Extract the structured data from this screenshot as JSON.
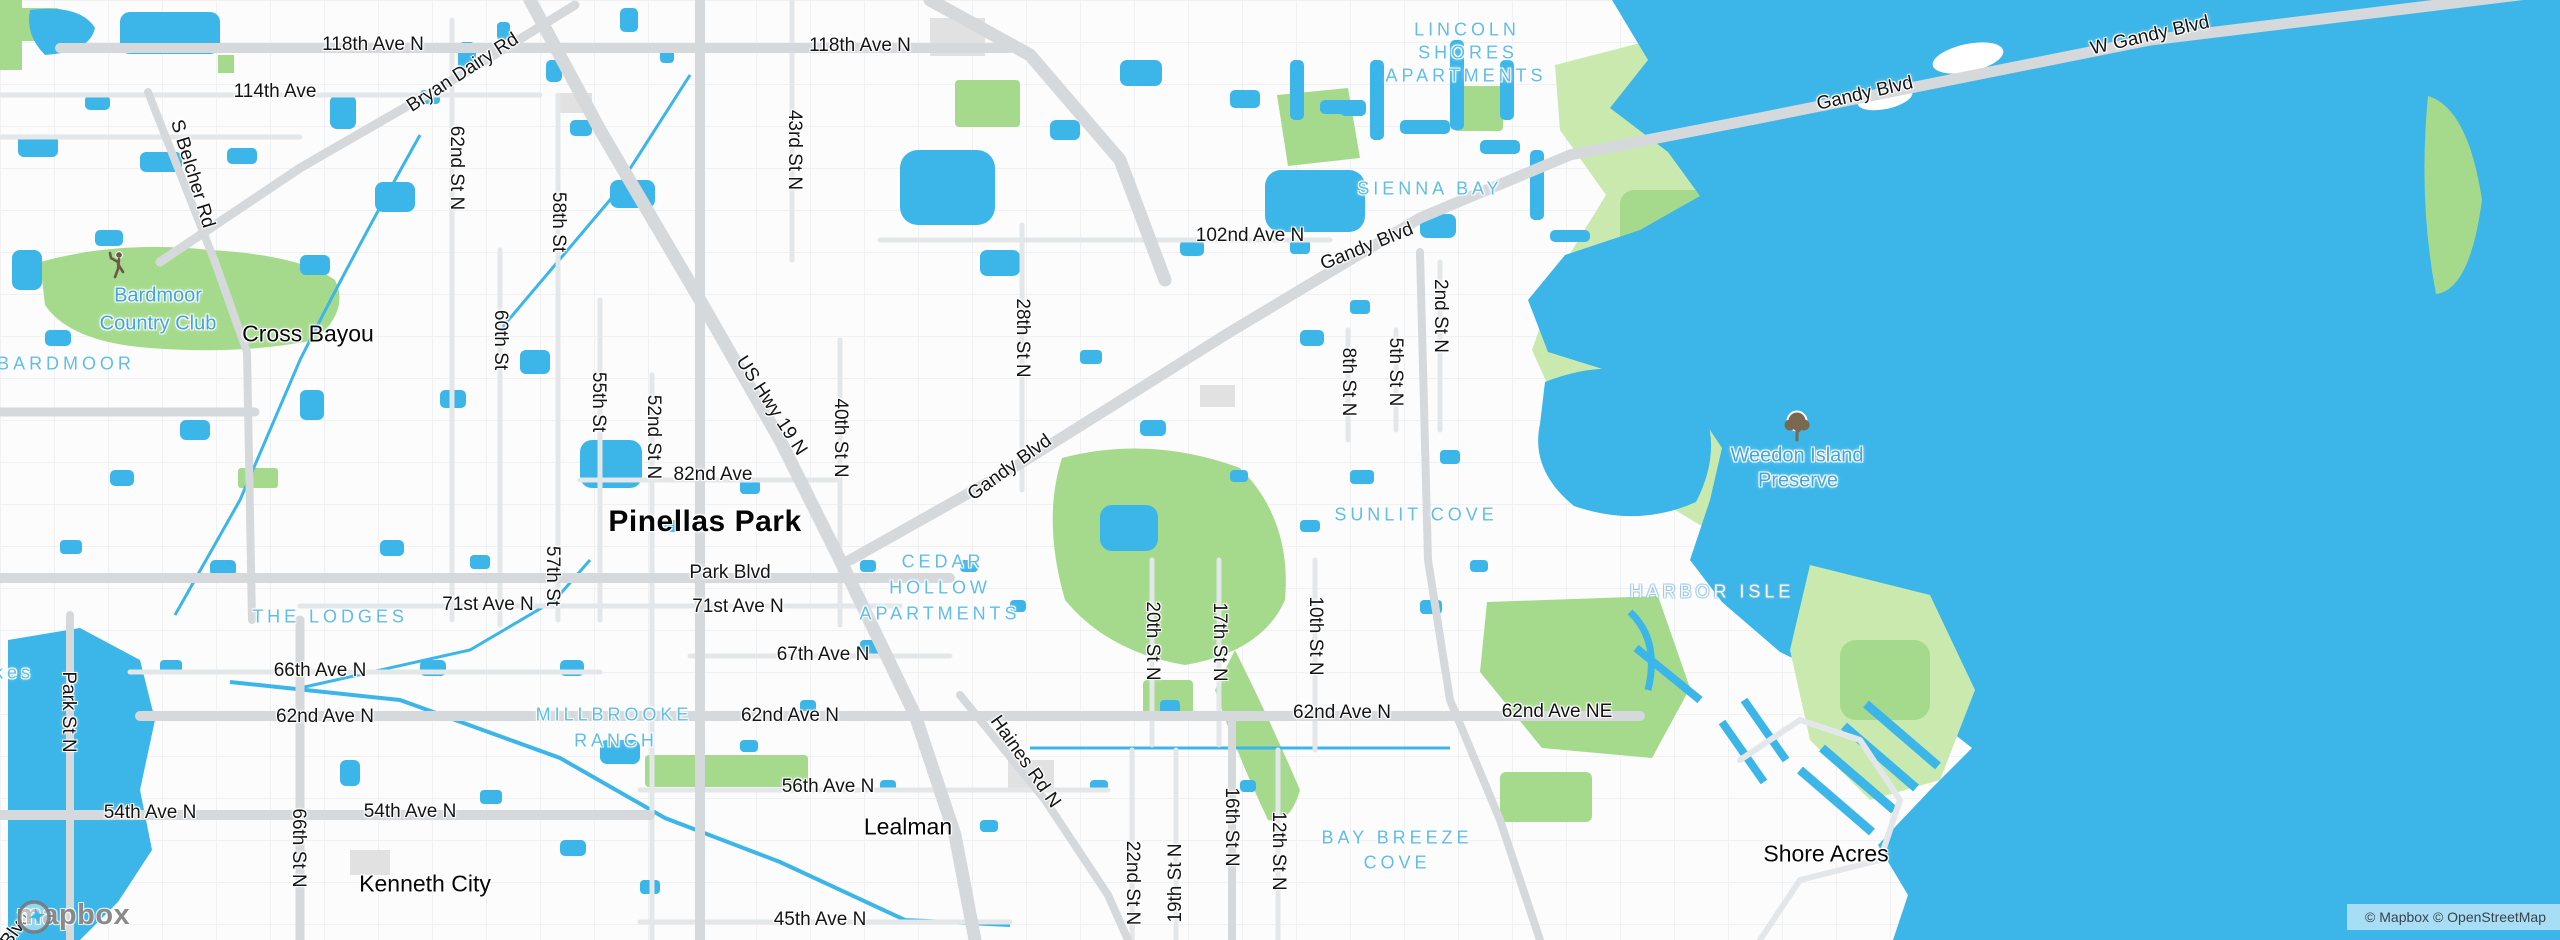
{
  "map": {
    "attribution": "© Mapbox © OpenStreetMap",
    "logo_text": "mapbox",
    "colors": {
      "water": "#3CB6E8",
      "park": "#A5DA8C",
      "preserve": "#C9E9AE",
      "land": "#FCFCFC",
      "road_major": "#D6D9DC",
      "road_minor": "#E4E7E9",
      "grid": "#EEF0F2",
      "building": "#E1E1E1",
      "label_road": "#141414",
      "label_city": "#060606",
      "label_poi": "#3FA5DE",
      "label_area": "#5FBDEB",
      "attribution_text": "#3A424B"
    },
    "icons": [
      {
        "name": "golfer-icon",
        "x": 120,
        "y": 265
      },
      {
        "name": "tree-icon",
        "x": 1797,
        "y": 427
      }
    ],
    "labels": [
      {
        "text": "118th Ave N",
        "x": 373,
        "y": 45,
        "t": "road"
      },
      {
        "text": "114th Ave",
        "x": 275,
        "y": 92,
        "t": "road"
      },
      {
        "text": "Bryan Dairy Rd",
        "x": 463,
        "y": 73,
        "t": "road",
        "rot": -33
      },
      {
        "text": "S Belcher Rd",
        "x": 192,
        "y": 174,
        "t": "road",
        "rot": 73
      },
      {
        "text": "118th Ave N",
        "x": 860,
        "y": 46,
        "t": "road"
      },
      {
        "text": "43rd St N",
        "x": 794,
        "y": 150,
        "t": "road",
        "rot": 90
      },
      {
        "text": "62nd St N",
        "x": 456,
        "y": 168,
        "t": "road",
        "rot": 90
      },
      {
        "text": "58th St",
        "x": 558,
        "y": 222,
        "t": "road",
        "rot": 90
      },
      {
        "text": "60th St",
        "x": 500,
        "y": 340,
        "t": "road",
        "rot": 90
      },
      {
        "text": "55th St",
        "x": 598,
        "y": 402,
        "t": "road",
        "rot": 90
      },
      {
        "text": "52nd St N",
        "x": 653,
        "y": 437,
        "t": "road",
        "rot": 90
      },
      {
        "text": "57th St",
        "x": 552,
        "y": 576,
        "t": "road",
        "rot": 90
      },
      {
        "text": "US Hwy 19 N",
        "x": 771,
        "y": 406,
        "t": "road",
        "rot": 57
      },
      {
        "text": "40th St N",
        "x": 840,
        "y": 438,
        "t": "road",
        "rot": 90
      },
      {
        "text": "28th St N",
        "x": 1022,
        "y": 338,
        "t": "road",
        "rot": 90
      },
      {
        "text": "102nd Ave N",
        "x": 1250,
        "y": 236,
        "t": "road"
      },
      {
        "text": "Gandy Blvd",
        "x": 1367,
        "y": 247,
        "t": "road",
        "rot": -22
      },
      {
        "text": "Gandy Blvd",
        "x": 1010,
        "y": 468,
        "t": "road",
        "rot": -36
      },
      {
        "text": "Gandy Blvd",
        "x": 1865,
        "y": 94,
        "t": "road",
        "rot": -13
      },
      {
        "text": "W Gandy Blvd",
        "x": 2150,
        "y": 36,
        "t": "road",
        "rot": -13
      },
      {
        "text": "82nd Ave",
        "x": 713,
        "y": 475,
        "t": "road"
      },
      {
        "text": "Park Blvd",
        "x": 730,
        "y": 573,
        "t": "road"
      },
      {
        "text": "71st Ave N",
        "x": 488,
        "y": 605,
        "t": "road"
      },
      {
        "text": "71st Ave N",
        "x": 738,
        "y": 607,
        "t": "road"
      },
      {
        "text": "67th Ave N",
        "x": 823,
        "y": 655,
        "t": "road"
      },
      {
        "text": "66th Ave N",
        "x": 320,
        "y": 671,
        "t": "road"
      },
      {
        "text": "62nd Ave N",
        "x": 325,
        "y": 717,
        "t": "road"
      },
      {
        "text": "62nd Ave N",
        "x": 790,
        "y": 716,
        "t": "road"
      },
      {
        "text": "62nd Ave N",
        "x": 1342,
        "y": 713,
        "t": "road"
      },
      {
        "text": "62nd Ave NE",
        "x": 1557,
        "y": 712,
        "t": "road"
      },
      {
        "text": "56th Ave N",
        "x": 828,
        "y": 787,
        "t": "road"
      },
      {
        "text": "54th Ave N",
        "x": 150,
        "y": 813,
        "t": "road"
      },
      {
        "text": "54th Ave N",
        "x": 410,
        "y": 812,
        "t": "road"
      },
      {
        "text": "45th Ave N",
        "x": 820,
        "y": 920,
        "t": "road"
      },
      {
        "text": "Haines Rd N",
        "x": 1025,
        "y": 762,
        "t": "road",
        "rot": 55
      },
      {
        "text": "Park St N",
        "x": 68,
        "y": 712,
        "t": "road",
        "rot": 90
      },
      {
        "text": "66th St N",
        "x": 298,
        "y": 848,
        "t": "road",
        "rot": 90
      },
      {
        "text": "20th St N",
        "x": 1152,
        "y": 641,
        "t": "road",
        "rot": 90
      },
      {
        "text": "17th St N",
        "x": 1219,
        "y": 642,
        "t": "road",
        "rot": 90
      },
      {
        "text": "10th St N",
        "x": 1315,
        "y": 636,
        "t": "road",
        "rot": 90
      },
      {
        "text": "16th St N",
        "x": 1231,
        "y": 827,
        "t": "road",
        "rot": 90
      },
      {
        "text": "12th St N",
        "x": 1278,
        "y": 851,
        "t": "road",
        "rot": 90
      },
      {
        "text": "19th St N",
        "x": 1176,
        "y": 883,
        "t": "road",
        "rot": -90
      },
      {
        "text": "22nd St N",
        "x": 1132,
        "y": 883,
        "t": "road",
        "rot": 90
      },
      {
        "text": "2nd St N",
        "x": 1440,
        "y": 316,
        "t": "road",
        "rot": 90
      },
      {
        "text": "5th St N",
        "x": 1395,
        "y": 372,
        "t": "road",
        "rot": 90
      },
      {
        "text": "8th St N",
        "x": 1348,
        "y": 382,
        "t": "road",
        "rot": 90
      },
      {
        "text": "Blvd",
        "x": 16,
        "y": 930,
        "t": "road",
        "rot": -55
      },
      {
        "text": "Pinellas Park",
        "x": 705,
        "y": 522,
        "t": "city-lg"
      },
      {
        "text": "Cross Bayou",
        "x": 308,
        "y": 334,
        "t": "city"
      },
      {
        "text": "Lealman",
        "x": 908,
        "y": 827,
        "t": "city"
      },
      {
        "text": "Kenneth City",
        "x": 425,
        "y": 884,
        "t": "city"
      },
      {
        "text": "Shore Acres",
        "x": 1826,
        "y": 854,
        "t": "city"
      },
      {
        "text": "Bardmoor",
        "x": 158,
        "y": 296,
        "t": "poi"
      },
      {
        "text": "Country Club",
        "x": 158,
        "y": 324,
        "t": "poi"
      },
      {
        "text": "Weedon Island",
        "x": 1797,
        "y": 456,
        "t": "poi"
      },
      {
        "text": "Preserve",
        "x": 1798,
        "y": 481,
        "t": "poi"
      },
      {
        "text": "BARDMOOR",
        "x": 66,
        "y": 364,
        "t": "area"
      },
      {
        "text": "THE LODGES",
        "x": 330,
        "y": 617,
        "t": "area"
      },
      {
        "text": "MILLBROOKE",
        "x": 614,
        "y": 715,
        "t": "area"
      },
      {
        "text": "RANCH",
        "x": 616,
        "y": 741,
        "t": "area"
      },
      {
        "text": "LINCOLN",
        "x": 1467,
        "y": 30,
        "t": "area"
      },
      {
        "text": "SHORES",
        "x": 1468,
        "y": 53,
        "t": "area"
      },
      {
        "text": "APARTMENTS",
        "x": 1466,
        "y": 76,
        "t": "area"
      },
      {
        "text": "SIENNA BAY",
        "x": 1430,
        "y": 189,
        "t": "area"
      },
      {
        "text": "CEDAR",
        "x": 943,
        "y": 562,
        "t": "area"
      },
      {
        "text": "HOLLOW",
        "x": 940,
        "y": 588,
        "t": "area"
      },
      {
        "text": "APARTMENTS",
        "x": 940,
        "y": 614,
        "t": "area"
      },
      {
        "text": "SUNLIT COVE",
        "x": 1416,
        "y": 515,
        "t": "area"
      },
      {
        "text": "HARBOR ISLE",
        "x": 1712,
        "y": 592,
        "t": "area-light"
      },
      {
        "text": "BAY BREEZE",
        "x": 1397,
        "y": 838,
        "t": "area"
      },
      {
        "text": "COVE",
        "x": 1397,
        "y": 863,
        "t": "area"
      },
      {
        "text": "kes",
        "x": 14,
        "y": 673,
        "t": "area"
      }
    ]
  }
}
